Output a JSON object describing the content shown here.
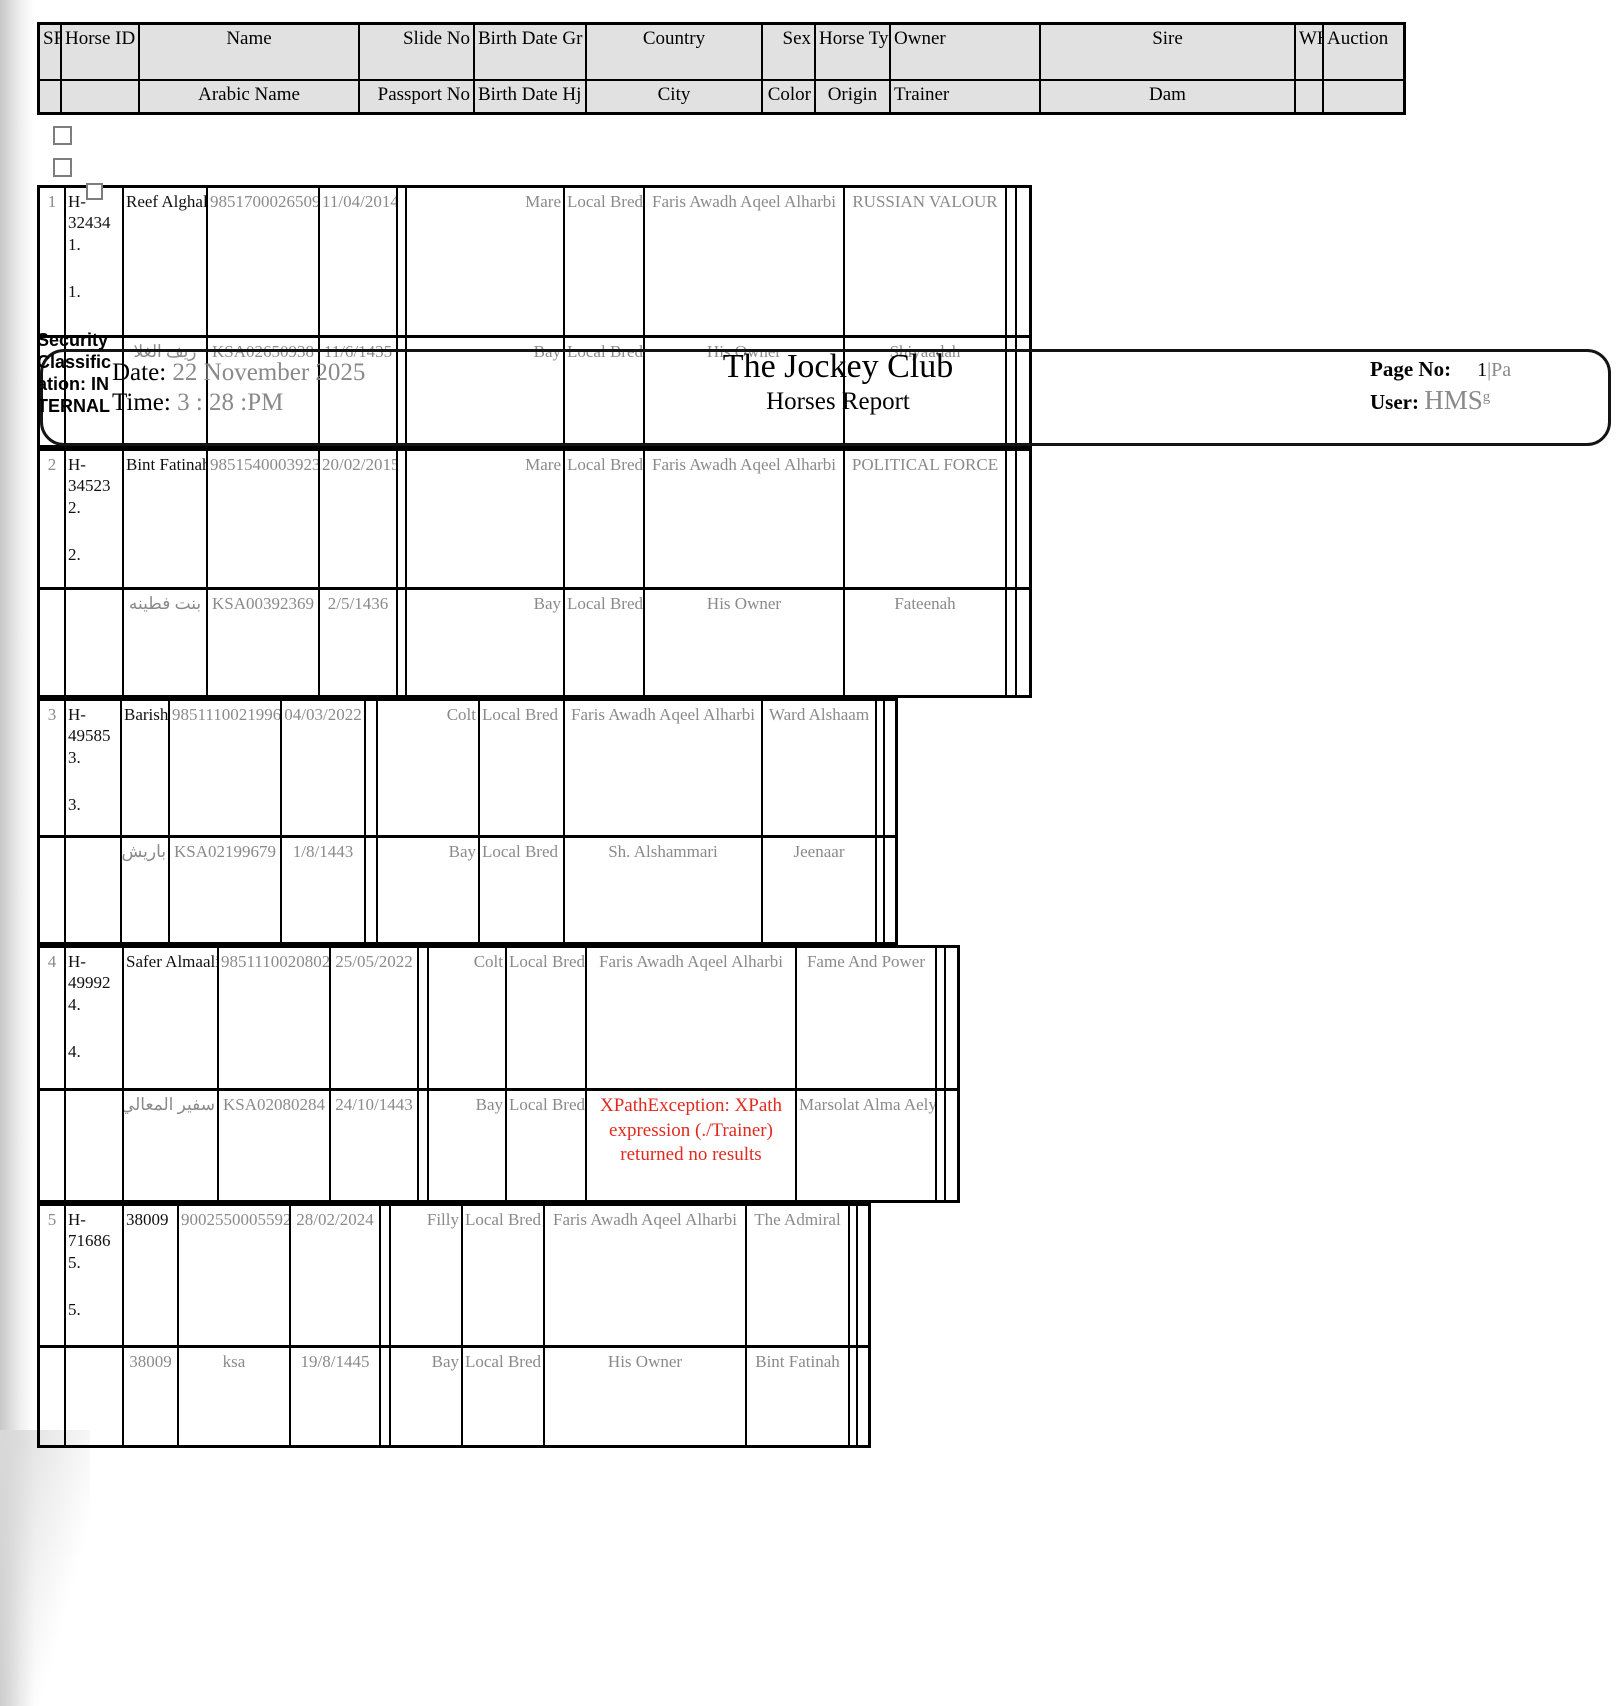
{
  "band": {
    "security_label": "Security Classification: INTERNAL",
    "date_label": "Date:",
    "date_value": "22 November 2025",
    "time_label": "Time:",
    "time_value": "3 : 28 :PM",
    "title": "The Jockey Club",
    "subtitle": "Horses Report",
    "page_no_label": "Page No:",
    "page_no_value": "1",
    "page_no_suffix": "|Pa",
    "user_label": "User:",
    "user_value": "HMS",
    "user_suffix": "g"
  },
  "table": {
    "header_row1": [
      "SR",
      "Horse ID",
      "Name",
      "Slide No",
      "Birth Date Gr",
      "Country",
      "Sex",
      "Horse Ty",
      "Owner",
      "Sire",
      "WHT",
      "Auction"
    ],
    "header_row2": [
      "",
      "",
      "Arabic Name",
      "Passport No",
      "Birth Date Hj",
      "City",
      "Color",
      "Origin",
      "Trainer",
      "Dam",
      "",
      ""
    ]
  },
  "rows": [
    {
      "sr": "1",
      "horse_id": "H-32434",
      "marker": "1.",
      "marker2": "1.",
      "name": "Reef Alghala",
      "slide_no": "985170002650938",
      "birth_gr": "11/04/2014",
      "sex": "Mare",
      "horse_ty": "Local Bred",
      "owner": "Faris Awadh Aqeel Alharbi",
      "sire": "RUSSIAN VALOUR",
      "arabic_name": "ريف الغلا",
      "passport": "KSA02650938",
      "birth_hj": "11/6/1435",
      "color": "Bay",
      "origin": "Local Bred",
      "trainer": "His Owner",
      "dam": "Shiyaadah"
    },
    {
      "sr": "2",
      "horse_id": "H-34523",
      "marker": "2.",
      "marker2": "2.",
      "name": "Bint Fatinah",
      "slide_no": "985154000392369",
      "birth_gr": "20/02/2015",
      "sex": "Mare",
      "horse_ty": "Local Bred",
      "owner": "Faris Awadh Aqeel Alharbi",
      "sire": "POLITICAL FORCE",
      "arabic_name": "بنت فطينه",
      "passport": "KSA00392369",
      "birth_hj": "2/5/1436",
      "color": "Bay",
      "origin": "Local Bred",
      "trainer": "His Owner",
      "dam": "Fateenah"
    },
    {
      "sr": "3",
      "horse_id": "H-49585",
      "marker": "3.",
      "marker2": "3.",
      "name": "Barish",
      "slide_no": "985111002199679",
      "birth_gr": "04/03/2022",
      "sex": "Colt",
      "horse_ty": "Local Bred",
      "owner": "Faris Awadh Aqeel Alharbi",
      "sire": "Ward Alshaam",
      "arabic_name": "باريش",
      "passport": "KSA02199679",
      "birth_hj": "1/8/1443",
      "color": "Bay",
      "origin": "Local Bred",
      "trainer": "Sh. Alshammari",
      "dam": "Jeenaar"
    },
    {
      "sr": "4",
      "horse_id": "H-49992",
      "marker": "4.",
      "marker2": "4.",
      "name": "Safer Almaali",
      "slide_no": "985111002080284",
      "birth_gr": "25/05/2022",
      "sex": "Colt",
      "horse_ty": "Local Bred",
      "owner": "Faris Awadh Aqeel Alharbi",
      "sire": "Fame And Power",
      "arabic_name": "سفير المعالي",
      "passport": "KSA02080284",
      "birth_hj": "24/10/1443",
      "color": "Bay",
      "origin": "Local Bred",
      "trainer_error": "XPathException: XPath expression (./Trainer) returned no results",
      "dam": "Marsolat Alma Aely"
    },
    {
      "sr": "5",
      "horse_id": "H-71686",
      "marker": "5.",
      "marker2": "5.",
      "name": "38009",
      "slide_no": "900255000559276",
      "birth_gr": "28/02/2024",
      "sex": "Filly",
      "horse_ty": "Local Bred",
      "owner": "Faris Awadh Aqeel Alharbi",
      "sire": "The Admiral",
      "arabic_name": "38009",
      "passport": "ksa",
      "birth_hj": "19/8/1445",
      "color": "Bay",
      "origin": "Local Bred",
      "trainer": "His Owner",
      "dam": "Bint Fatinah"
    }
  ],
  "colors": {
    "error": "#e02a1f",
    "muted": "#8a8a8a",
    "header_bg": "#e1e1e1"
  }
}
